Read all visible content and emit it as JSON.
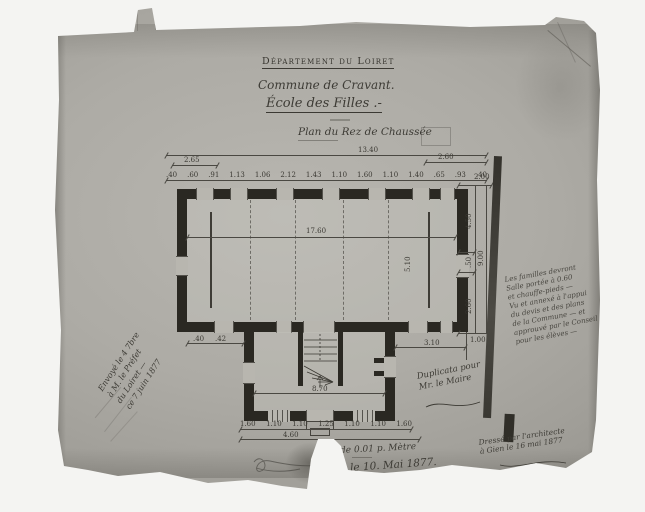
{
  "palette": {
    "photo_bg": "#f4f4f2",
    "paper": "#adaba5",
    "paper_light": "#b8b6b0",
    "paper_dark": "#918f89",
    "ink": "#3b3933",
    "wall": "#2a2822"
  },
  "header": {
    "department": "Département du Loiret",
    "commune": "Commune de Cravant.",
    "school": "École des Filles .-"
  },
  "plan": {
    "title": "Plan du Rez de Chaussée"
  },
  "dims": {
    "overall_top": "13.40",
    "top_left": "2.65",
    "top_right": "2.60",
    "top_chain": [
      ".40",
      ".60",
      ".91",
      "1.13",
      "1.06",
      "2.12",
      "1.43",
      "1.10",
      "1.60",
      "1.10",
      "1.40",
      ".65",
      ".93",
      ".40"
    ],
    "room_length": "17.60",
    "room_width": "5.10",
    "right_top": "2.00",
    "right_overall": "9.00",
    "right_sub_upper": "4.50",
    "right_sub_mid": ".50",
    "right_sub_lower": "2.60",
    "right_bottom": "1.00",
    "annex_width": "8.70",
    "annex_right_offset": "3.10",
    "annex_left_a": ".40",
    "annex_left_b": ".42",
    "bottom_chain": [
      "1.60",
      "1.10",
      "1.10",
      "1.25",
      "1.10",
      "1.10",
      "1.60"
    ],
    "bottom_overall": "4.60"
  },
  "notes": {
    "right_block": [
      "Les familles devront",
      "Salle portée à 0.60",
      "et chauffe-pieds —",
      "Vu et annexé à l'appui",
      "du devis et des plans",
      "de la Commune — et",
      "approuvé par le Conseil",
      "pour les élèves —"
    ],
    "left_block": [
      "Envoyé le 4 7bre",
      "à M. le Préfet",
      "du Loiret —",
      "ce 7 juin 1877"
    ],
    "duplicata": [
      "Duplicata pour",
      "Mr. le Maire"
    ],
    "bottom_right": [
      "Dressé par l'architecte",
      "à Gien le 16 mai 1877"
    ],
    "scale_note": "de 0.01 p. Mètre",
    "date_note": "le 10. Mai 1877."
  }
}
